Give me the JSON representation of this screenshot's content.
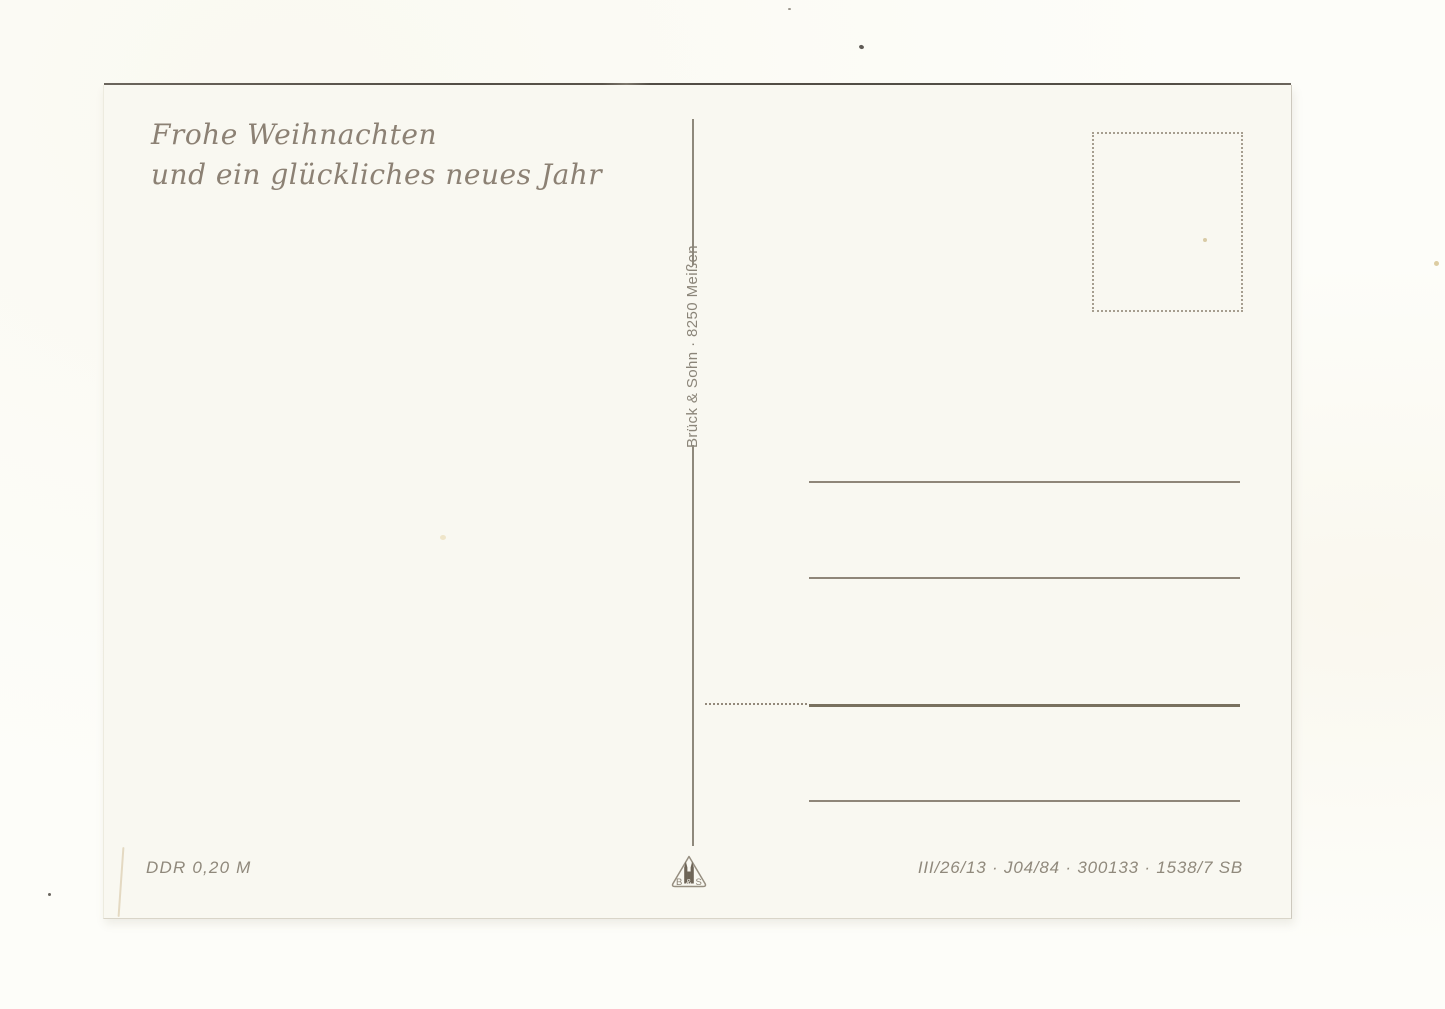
{
  "postcard": {
    "greeting": {
      "line1": "Frohe Weihnachten",
      "line2": "und ein glückliches neues Jahr"
    },
    "publisher": "Brück & Sohn · 8250 Meißen",
    "denomination": "DDR 0,20 M",
    "print_code": "III/26/13 · J04/84 · 300133 · 1538/7 SB",
    "logo": {
      "left_letter": "B",
      "ampersand": "&",
      "right_letter": "S"
    },
    "address_lines": 4,
    "colors": {
      "card_background": "#f9f8f1",
      "scan_background": "#fdfdf9",
      "greeting_ink": "#8c8174",
      "rule_line": "#8f8679",
      "rule_line_bold": "#79715f",
      "top_edge_shadow": "#534e46"
    }
  }
}
